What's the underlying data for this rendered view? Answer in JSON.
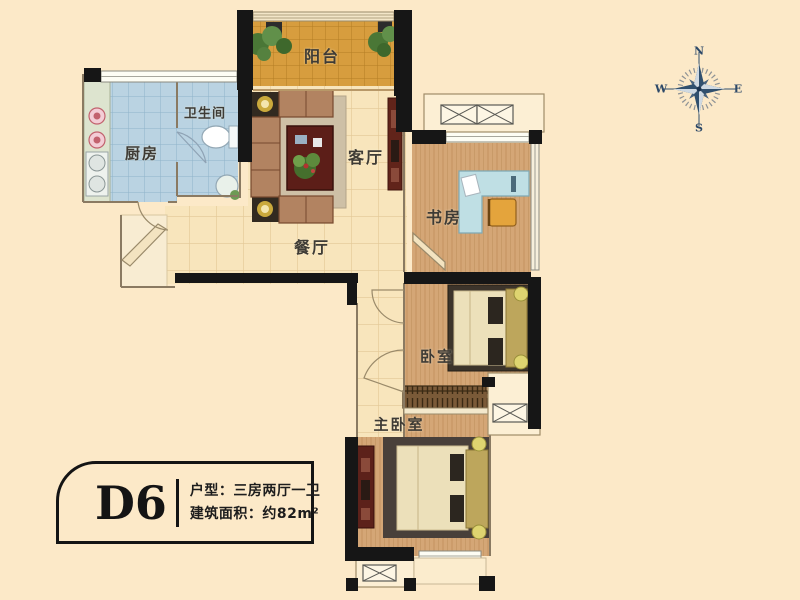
{
  "title": "D6 户型平面图",
  "rooms": {
    "balcony": "阳台",
    "kitchen": "厨房",
    "bathroom": "卫生间",
    "living": "客厅",
    "dining": "餐厅",
    "study": "书房",
    "bedroom": "卧室",
    "master_bedroom": "主卧室"
  },
  "compass": {
    "north": "N",
    "east": "E",
    "south": "S",
    "west": "W"
  },
  "info_box": {
    "unit": "D6",
    "type_line": "户型：三房两厅一卫",
    "area_line": "建筑面积：约82m²"
  },
  "colors": {
    "background": "#fce9c8",
    "wall": "#161616",
    "balcony_floor": "#d79d3e",
    "wet_room_floor": "#bad3e2",
    "hall_tile_floor": "#f8e5bc",
    "wood_floor": "#d4a676",
    "wardrobe": "#7a5a38",
    "bed_linen": "#ece0ba",
    "headboard_gold": "#bda65c",
    "cabinet_red": "#5c211a",
    "desk_blue": "#bfdfe4",
    "chair_orange": "#e4a43c",
    "compass": "#31506e"
  }
}
